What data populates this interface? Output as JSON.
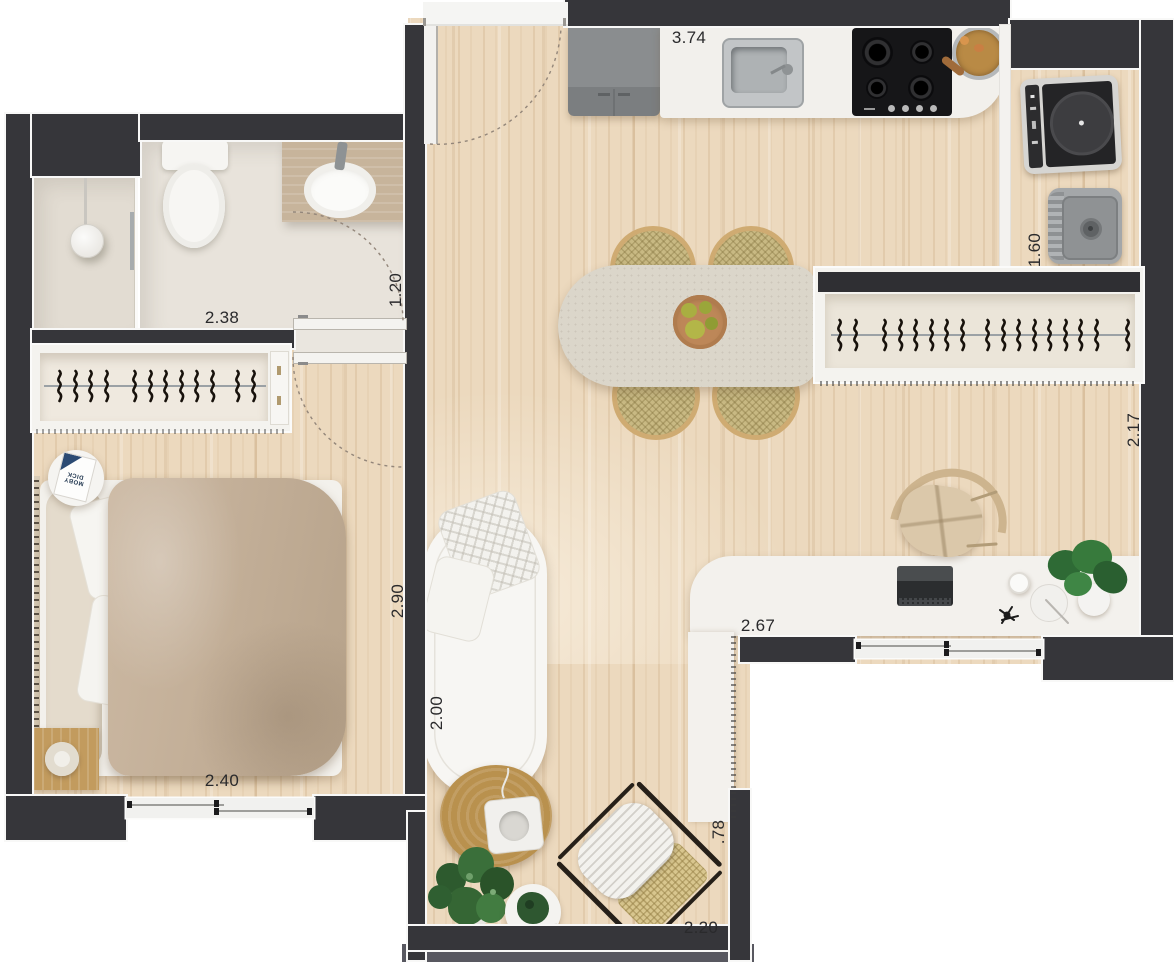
{
  "floor_plan": {
    "dimension_labels": [
      {
        "id": "kitchen_counter",
        "text": "3.74",
        "orientation": "horizontal"
      },
      {
        "id": "laundry",
        "text": "1.60",
        "orientation": "vertical"
      },
      {
        "id": "bathroom_width",
        "text": "2.38",
        "orientation": "horizontal"
      },
      {
        "id": "bathroom_entry",
        "text": "1.20",
        "orientation": "vertical"
      },
      {
        "id": "hall_rack_wall",
        "text": "2.17",
        "orientation": "vertical"
      },
      {
        "id": "bedroom_depth",
        "text": "2.90",
        "orientation": "vertical"
      },
      {
        "id": "bedroom_width",
        "text": "2.40",
        "orientation": "horizontal"
      },
      {
        "id": "sofa_length",
        "text": "2.00",
        "orientation": "vertical"
      },
      {
        "id": "desk_length",
        "text": "2.67",
        "orientation": "horizontal"
      },
      {
        "id": "balcony_depth",
        "text": ".78",
        "orientation": "vertical"
      },
      {
        "id": "balcony_width",
        "text": "2.20",
        "orientation": "horizontal"
      }
    ],
    "bedside_book_title": "MOBY DICK",
    "hangers": {
      "bedroom_wardrobe_groups": [
        4,
        6,
        2
      ],
      "entry_rack_groups": [
        2,
        6,
        8,
        1
      ]
    },
    "colors": {
      "wall": "#36363a",
      "wood_floor": "#ecd9be",
      "bathroom_tile": "#e8e3db",
      "counter_white": "#f2f0ec",
      "duvet_beige": "#c3af98",
      "rattan": "#c8b983",
      "plant_green": "#33663a",
      "appliance_black": "#161618"
    }
  }
}
